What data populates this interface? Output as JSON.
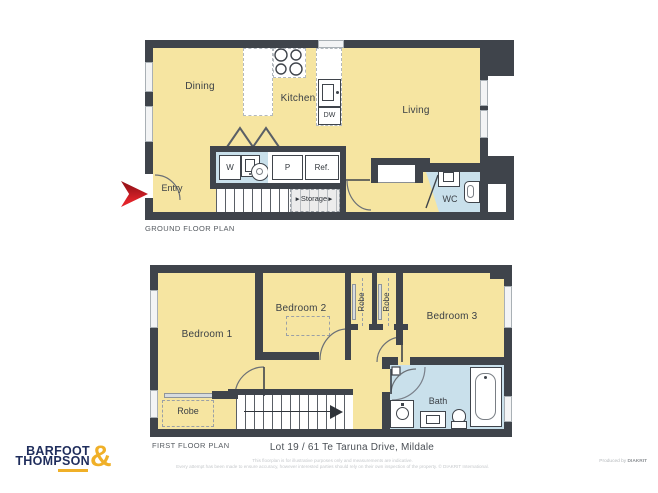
{
  "brand": {
    "name_line1": "BARFOOT",
    "name_line2": "THOMPSON",
    "ampersand": "&"
  },
  "ground_floor": {
    "caption": "GROUND FLOOR PLAN",
    "rooms": {
      "dining": "Dining",
      "kitchen": "Kitchen",
      "living": "Living",
      "entry": "Entry",
      "wc": "WC"
    },
    "storage": {
      "label": "Storage",
      "arrow": "►"
    },
    "fixtures": {
      "washer": "W",
      "pantry": "P",
      "fridge": "Ref.",
      "dishwasher": "DW"
    }
  },
  "first_floor": {
    "caption": "FIRST FLOOR PLAN",
    "rooms": {
      "bedroom1": "Bedroom 1",
      "bedroom2": "Bedroom 2",
      "bedroom3": "Bedroom 3",
      "bath": "Bath"
    },
    "robes": {
      "bedroom1_robe": "Robe",
      "robe_left": "Robe",
      "robe_right": "Robe"
    }
  },
  "address": "Lot 19 / 61 Te Taruna Drive, Mildale",
  "disclaimer": {
    "line1": "This floorplan is for illustrative purposes only and measurements are indicative.",
    "line2": "Every attempt has been made to ensure accuracy, however interested parties should rely on their own inspection of the property. © DIAKRIT International."
  },
  "credit": {
    "prefix": "Produced by ",
    "brand": "DIAKRIT"
  },
  "colors": {
    "room_fill": "#F6E5A1",
    "wet_area_fill": "#C9E0EB",
    "wall": "#3F444B",
    "entry_arrow_red": "#D8232A",
    "brand_navy": "#1F2D5C",
    "brand_gold": "#F0B028"
  }
}
